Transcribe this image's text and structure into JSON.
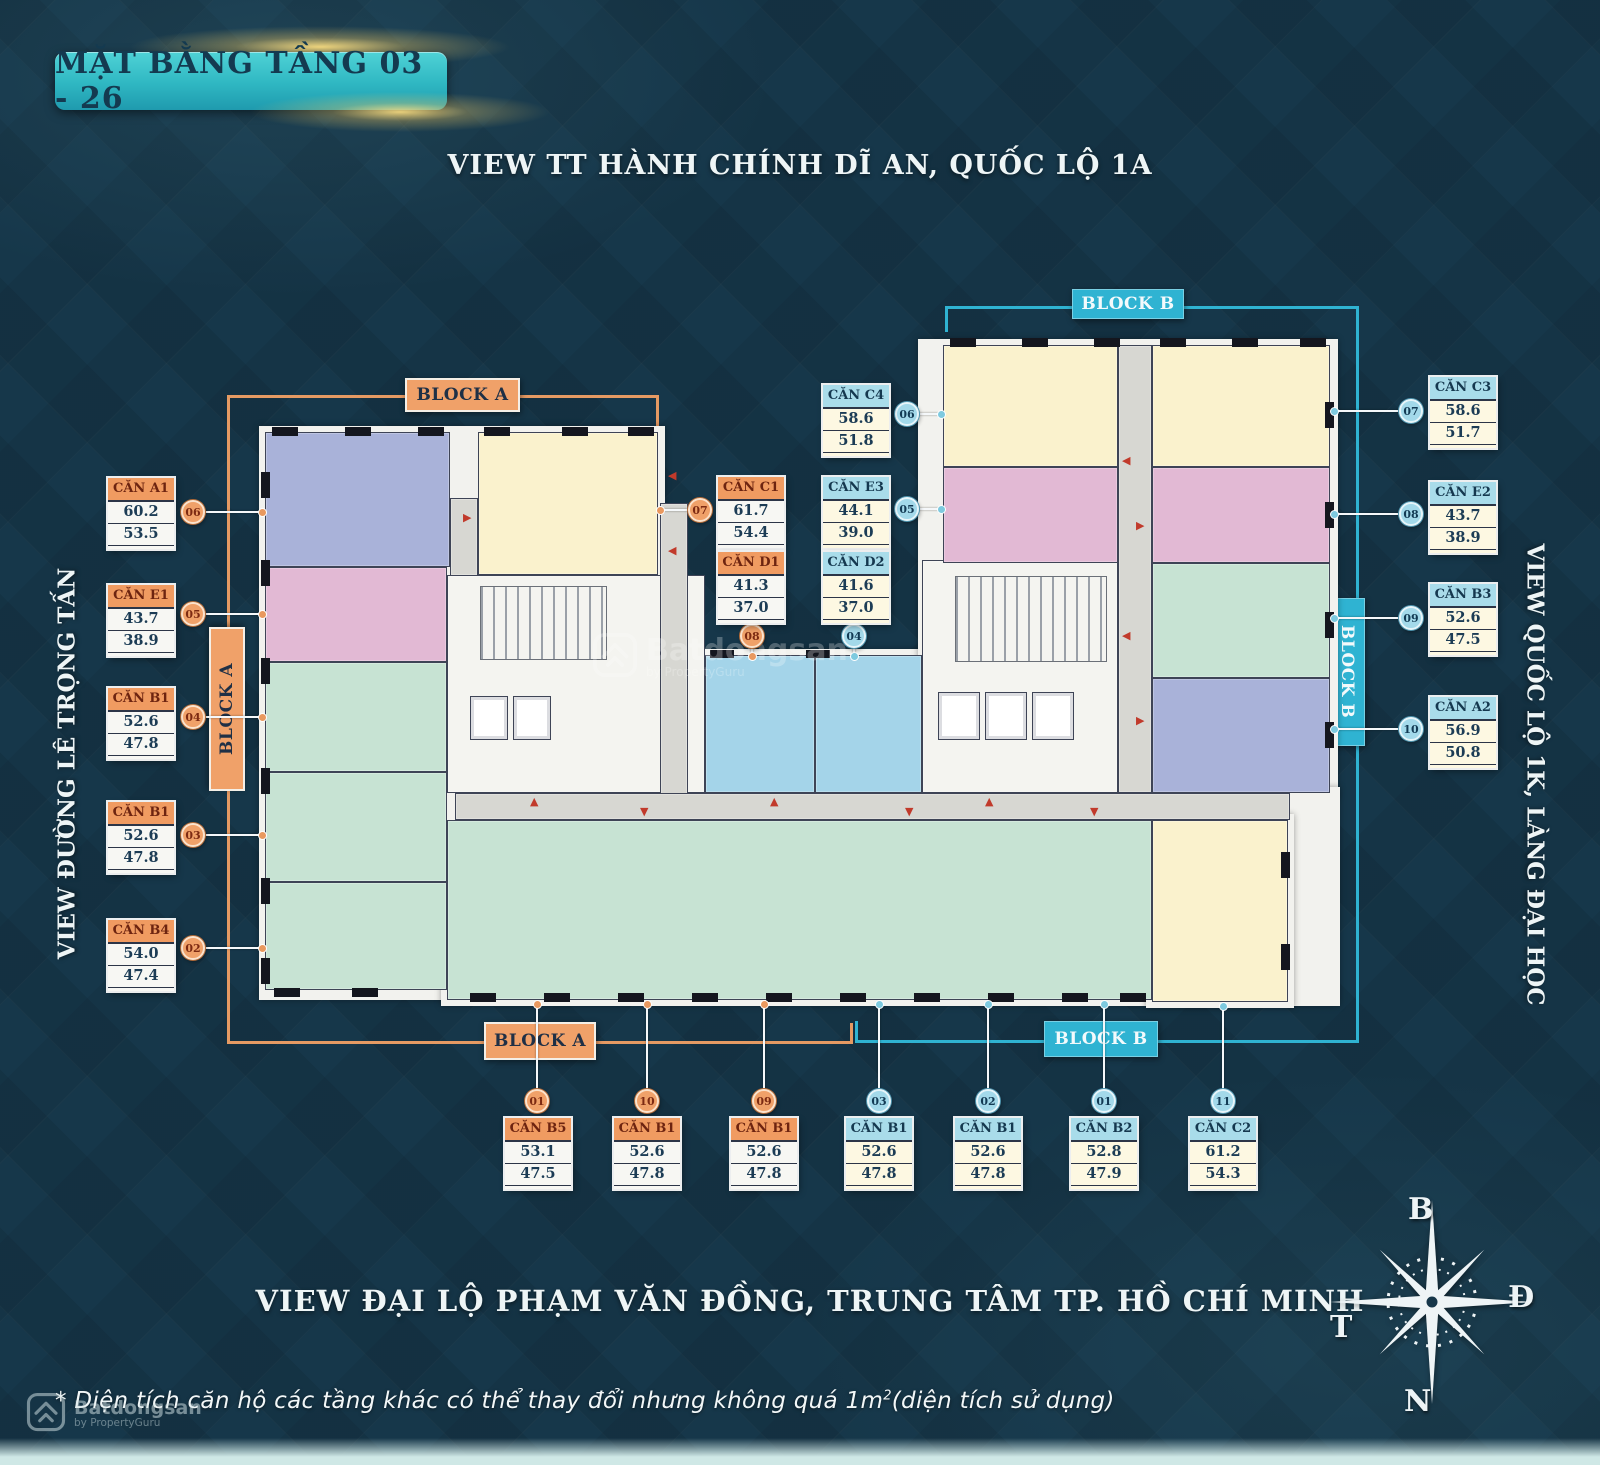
{
  "header": {
    "title": "MẶT BẰNG TẦNG 03 - 26"
  },
  "views": {
    "top": "VIEW  TT HÀNH CHÍNH DĨ AN, QUỐC LỘ 1A",
    "bottom": "VIEW ĐẠI LỘ PHẠM VĂN ĐỒNG, TRUNG TÂM TP. HỒ CHÍ MINH",
    "left": "VIEW ĐƯỜNG LÊ TRỌNG TẤN",
    "right": "VIEW QUỐC LỘ 1K, LÀNG ĐẠI HỌC"
  },
  "blocks": {
    "a": "BLOCK A",
    "b": "BLOCK B"
  },
  "compass": {
    "north": "B",
    "east": "Đ",
    "west": "T",
    "south": "N"
  },
  "footnote": {
    "part1": "* Diện tích căn hộ các tầng khác có thể thay đổi nhưng không quá 1m",
    "sup": "2",
    "part2": "(diện tích sử dụng)"
  },
  "watermark": {
    "brand": "Batdongsan",
    "sub": "by PropertyGuru"
  },
  "colors": {
    "background": "#16374a",
    "accent_orange": "#e59a63",
    "accent_cyan": "#2fb3d2",
    "title_badge": "#2fb7c2",
    "title_text": "#143a50",
    "card_header_a": "#f09b61",
    "card_header_a_text": "#6d2410",
    "card_header_b": "#a9dcea",
    "card_header_b_text": "#15384f",
    "card_body_a": "#f7f7f3",
    "card_body_b": "#fdf8e2",
    "number_text": "#1c3c55",
    "marker_red": "#c13a2b",
    "connector": "#f5f8fa"
  },
  "units": [
    {
      "id": "a1-06",
      "name": "CĂN A1",
      "area1": "60.2",
      "area2": "53.5",
      "num": "06",
      "block": "A",
      "card": [
        108,
        478
      ],
      "circle": [
        193,
        512
      ],
      "line": [
        204,
        511,
        265,
        511
      ],
      "dot": [
        262,
        512
      ]
    },
    {
      "id": "e1-05",
      "name": "CĂN E1",
      "area1": "43.7",
      "area2": "38.9",
      "num": "05",
      "block": "A",
      "card": [
        108,
        585
      ],
      "circle": [
        193,
        614
      ],
      "line": [
        204,
        613,
        265,
        613
      ],
      "dot": [
        262,
        614
      ]
    },
    {
      "id": "b1-04",
      "name": "CĂN B1",
      "area1": "52.6",
      "area2": "47.8",
      "num": "04",
      "block": "A",
      "card": [
        108,
        688
      ],
      "circle": [
        193,
        717
      ],
      "line": [
        204,
        716,
        265,
        716
      ],
      "dot": [
        262,
        717
      ]
    },
    {
      "id": "b1-03",
      "name": "CĂN B1",
      "area1": "52.6",
      "area2": "47.8",
      "num": "03",
      "block": "A",
      "card": [
        108,
        802
      ],
      "circle": [
        193,
        835
      ],
      "line": [
        204,
        834,
        265,
        834
      ],
      "dot": [
        262,
        835
      ]
    },
    {
      "id": "b4-02",
      "name": "CĂN B4",
      "area1": "54.0",
      "area2": "47.4",
      "num": "02",
      "block": "A",
      "card": [
        108,
        920
      ],
      "circle": [
        193,
        948
      ],
      "line": [
        204,
        947,
        265,
        947
      ],
      "dot": [
        262,
        948
      ]
    },
    {
      "id": "c1-07",
      "name": "CĂN C1",
      "area1": "61.7",
      "area2": "54.4",
      "num": "07",
      "block": "A",
      "card": [
        718,
        477
      ],
      "circle": [
        700,
        510
      ],
      "line": [
        658,
        509,
        689,
        509
      ],
      "dot": [
        660,
        510
      ]
    },
    {
      "id": "d1-08",
      "name": "CĂN D1",
      "area1": "41.3",
      "area2": "37.0",
      "num": "08",
      "block": "A",
      "card": [
        718,
        552
      ],
      "circle": [
        752,
        636
      ],
      "line": [
        751,
        647,
        751,
        657
      ],
      "dot": [
        752,
        656
      ]
    },
    {
      "id": "c4-06",
      "name": "CĂN C4",
      "area1": "58.6",
      "area2": "51.8",
      "num": "06",
      "block": "B",
      "card": [
        823,
        385
      ],
      "circle": [
        907,
        414
      ],
      "line": [
        918,
        413,
        943,
        413
      ],
      "dot": [
        941,
        414
      ]
    },
    {
      "id": "e3-05",
      "name": "CĂN E3",
      "area1": "44.1",
      "area2": "39.0",
      "num": "05",
      "block": "B",
      "card": [
        823,
        477
      ],
      "circle": [
        907,
        509
      ],
      "line": [
        918,
        508,
        943,
        508
      ],
      "dot": [
        941,
        509
      ]
    },
    {
      "id": "d2-04",
      "name": "CĂN D2",
      "area1": "41.6",
      "area2": "37.0",
      "num": "04",
      "block": "B",
      "card": [
        823,
        552
      ],
      "circle": [
        854,
        636
      ],
      "line": [
        853,
        647,
        853,
        657
      ],
      "dot": [
        854,
        656
      ]
    },
    {
      "id": "c3-07",
      "name": "CĂN C3",
      "area1": "58.6",
      "area2": "51.7",
      "num": "07",
      "block": "B",
      "card": [
        1430,
        377
      ],
      "circle": [
        1411,
        411
      ],
      "line": [
        1332,
        410,
        1399,
        410
      ],
      "dot": [
        1334,
        411
      ]
    },
    {
      "id": "e2-08",
      "name": "CĂN E2",
      "area1": "43.7",
      "area2": "38.9",
      "num": "08",
      "block": "B",
      "card": [
        1430,
        482
      ],
      "circle": [
        1411,
        514
      ],
      "line": [
        1332,
        513,
        1399,
        513
      ],
      "dot": [
        1334,
        514
      ]
    },
    {
      "id": "b3-09",
      "name": "CĂN B3",
      "area1": "52.6",
      "area2": "47.5",
      "num": "09",
      "block": "B",
      "card": [
        1430,
        584
      ],
      "circle": [
        1411,
        618
      ],
      "line": [
        1332,
        617,
        1399,
        617
      ],
      "dot": [
        1334,
        618
      ]
    },
    {
      "id": "a2-10",
      "name": "CĂN A2",
      "area1": "56.9",
      "area2": "50.8",
      "num": "10",
      "block": "B",
      "card": [
        1430,
        697
      ],
      "circle": [
        1411,
        729
      ],
      "line": [
        1332,
        728,
        1399,
        728
      ],
      "dot": [
        1334,
        729
      ]
    },
    {
      "id": "b5-01",
      "name": "CĂN B5",
      "area1": "53.1",
      "area2": "47.5",
      "num": "01",
      "block": "A",
      "card": [
        505,
        1118
      ],
      "circle": [
        537,
        1101
      ],
      "line": [
        536,
        1002,
        536,
        1089
      ],
      "dot": [
        537,
        1004
      ]
    },
    {
      "id": "b1-10",
      "name": "CĂN B1",
      "area1": "52.6",
      "area2": "47.8",
      "num": "10",
      "block": "A",
      "card": [
        614,
        1118
      ],
      "circle": [
        647,
        1101
      ],
      "line": [
        646,
        1002,
        646,
        1089
      ],
      "dot": [
        647,
        1004
      ]
    },
    {
      "id": "b1-09",
      "name": "CĂN B1",
      "area1": "52.6",
      "area2": "47.8",
      "num": "09",
      "block": "A",
      "card": [
        731,
        1118
      ],
      "circle": [
        764,
        1101
      ],
      "line": [
        763,
        1002,
        763,
        1089
      ],
      "dot": [
        764,
        1004
      ]
    },
    {
      "id": "b1-b03",
      "name": "CĂN B1",
      "area1": "52.6",
      "area2": "47.8",
      "num": "03",
      "block": "B",
      "card": [
        846,
        1118
      ],
      "circle": [
        879,
        1101
      ],
      "line": [
        878,
        1002,
        878,
        1089
      ],
      "dot": [
        879,
        1004
      ]
    },
    {
      "id": "b1-b02",
      "name": "CĂN B1",
      "area1": "52.6",
      "area2": "47.8",
      "num": "02",
      "block": "B",
      "card": [
        955,
        1118
      ],
      "circle": [
        988,
        1101
      ],
      "line": [
        987,
        1002,
        987,
        1089
      ],
      "dot": [
        988,
        1004
      ]
    },
    {
      "id": "b2-b01",
      "name": "CĂN B2",
      "area1": "52.8",
      "area2": "47.9",
      "num": "01",
      "block": "B",
      "card": [
        1071,
        1118
      ],
      "circle": [
        1104,
        1101
      ],
      "line": [
        1103,
        1002,
        1103,
        1089
      ],
      "dot": [
        1104,
        1004
      ]
    },
    {
      "id": "c2-11",
      "name": "CĂN C2",
      "area1": "61.2",
      "area2": "54.3",
      "num": "11",
      "block": "B",
      "card": [
        1190,
        1118
      ],
      "circle": [
        1223,
        1101
      ],
      "line": [
        1222,
        1004,
        1222,
        1089
      ],
      "dot": [
        1223,
        1006
      ]
    }
  ],
  "floorplan": {
    "palette": {
      "lavender": "#a9b2d9",
      "pink": "#e2b9d4",
      "green": "#c7e3d3",
      "yellow": "#faf2cd",
      "blue": "#a4d4e9",
      "gray": "#d7d7d2",
      "white": "#f4f4f0"
    },
    "backdrops": [
      [
        259,
        426,
        406,
        574
      ],
      [
        700,
        649,
        228,
        150
      ],
      [
        918,
        339,
        420,
        460
      ],
      [
        441,
        787,
        899,
        219
      ],
      [
        1146,
        814,
        148,
        194
      ]
    ],
    "rooms": [
      {
        "id": "unit-a1-room",
        "fill": "lavender",
        "r": [
          265,
          432,
          185,
          135
        ]
      },
      {
        "id": "unit-c1-room",
        "fill": "yellow",
        "r": [
          478,
          432,
          180,
          143
        ]
      },
      {
        "id": "unit-e1-room",
        "fill": "pink",
        "r": [
          265,
          567,
          182,
          95
        ]
      },
      {
        "id": "unit-b1-04-room",
        "fill": "green",
        "r": [
          265,
          662,
          182,
          110
        ]
      },
      {
        "id": "unit-b1-03-room",
        "fill": "green",
        "r": [
          265,
          772,
          182,
          110
        ]
      },
      {
        "id": "unit-b4-02-room",
        "fill": "green",
        "r": [
          265,
          882,
          182,
          108
        ]
      },
      {
        "id": "corridor-a-top",
        "fill": "gray",
        "r": [
          450,
          498,
          28,
          78
        ]
      },
      {
        "id": "core-a",
        "fill": "white",
        "r": [
          447,
          575,
          258,
          218
        ]
      },
      {
        "id": "corridor-center",
        "fill": "gray",
        "r": [
          660,
          503,
          28,
          292
        ]
      },
      {
        "id": "unit-d1-room",
        "fill": "blue",
        "r": [
          705,
          655,
          110,
          138
        ]
      },
      {
        "id": "unit-d2-room",
        "fill": "blue",
        "r": [
          815,
          655,
          107,
          138
        ]
      },
      {
        "id": "core-center",
        "fill": "white",
        "r": [
          922,
          560,
          196,
          233
        ]
      },
      {
        "id": "unit-c4-room",
        "fill": "yellow",
        "r": [
          943,
          345,
          175,
          122
        ]
      },
      {
        "id": "unit-c3-room",
        "fill": "yellow",
        "r": [
          1152,
          345,
          178,
          122
        ]
      },
      {
        "id": "unit-e3-room",
        "fill": "pink",
        "r": [
          943,
          467,
          175,
          96
        ]
      },
      {
        "id": "unit-e2-room",
        "fill": "pink",
        "r": [
          1152,
          467,
          178,
          96
        ]
      },
      {
        "id": "unit-b3-room",
        "fill": "green",
        "r": [
          1152,
          563,
          178,
          115
        ]
      },
      {
        "id": "unit-a2-room",
        "fill": "lavender",
        "r": [
          1152,
          678,
          178,
          115
        ]
      },
      {
        "id": "corridor-b-vert",
        "fill": "gray",
        "r": [
          1118,
          345,
          34,
          448
        ]
      },
      {
        "id": "corridor-main",
        "fill": "gray",
        "r": [
          455,
          793,
          835,
          27
        ]
      },
      {
        "id": "wing-studios",
        "fill": "green",
        "r": [
          447,
          820,
          705,
          180
        ],
        "cls": "wing"
      },
      {
        "id": "unit-c2-room",
        "fill": "yellow",
        "r": [
          1152,
          820,
          136,
          182
        ]
      }
    ],
    "stairs": [
      [
        480,
        586,
        125,
        72
      ],
      [
        955,
        576,
        150,
        84
      ]
    ],
    "elevators": [
      [
        470,
        696,
        38,
        44
      ],
      [
        513,
        696,
        38,
        44
      ],
      [
        938,
        692,
        42,
        48
      ],
      [
        985,
        692,
        42,
        48
      ],
      [
        1032,
        692,
        42,
        48
      ]
    ],
    "piers": [
      [
        272,
        427,
        26,
        9
      ],
      [
        345,
        427,
        26,
        9
      ],
      [
        418,
        427,
        26,
        9
      ],
      [
        484,
        427,
        26,
        9
      ],
      [
        562,
        427,
        26,
        9
      ],
      [
        628,
        427,
        26,
        9
      ],
      [
        261,
        472,
        9,
        26
      ],
      [
        261,
        560,
        9,
        26
      ],
      [
        261,
        658,
        9,
        26
      ],
      [
        261,
        768,
        9,
        26
      ],
      [
        261,
        878,
        9,
        26
      ],
      [
        261,
        958,
        9,
        26
      ],
      [
        274,
        988,
        26,
        9
      ],
      [
        352,
        988,
        26,
        9
      ],
      [
        470,
        993,
        26,
        9
      ],
      [
        544,
        993,
        26,
        9
      ],
      [
        618,
        993,
        26,
        9
      ],
      [
        692,
        993,
        26,
        9
      ],
      [
        766,
        993,
        26,
        9
      ],
      [
        840,
        993,
        26,
        9
      ],
      [
        914,
        993,
        26,
        9
      ],
      [
        988,
        993,
        26,
        9
      ],
      [
        1062,
        993,
        26,
        9
      ],
      [
        1120,
        993,
        26,
        9
      ],
      [
        950,
        338,
        26,
        9
      ],
      [
        1022,
        338,
        26,
        9
      ],
      [
        1094,
        338,
        26,
        9
      ],
      [
        1160,
        338,
        26,
        9
      ],
      [
        1232,
        338,
        26,
        9
      ],
      [
        1300,
        338,
        26,
        9
      ],
      [
        1325,
        402,
        9,
        26
      ],
      [
        1325,
        502,
        9,
        26
      ],
      [
        1325,
        612,
        9,
        26
      ],
      [
        1325,
        722,
        9,
        26
      ],
      [
        1281,
        852,
        9,
        26
      ],
      [
        1281,
        944,
        9,
        26
      ],
      [
        710,
        650,
        24,
        8
      ],
      [
        806,
        650,
        24,
        8
      ]
    ],
    "markers": [
      {
        "d": "right",
        "x": 463,
        "y": 512
      },
      {
        "d": "left",
        "x": 668,
        "y": 470
      },
      {
        "d": "left",
        "x": 668,
        "y": 545
      },
      {
        "d": "up",
        "x": 530,
        "y": 796
      },
      {
        "d": "down",
        "x": 640,
        "y": 806
      },
      {
        "d": "up",
        "x": 770,
        "y": 796
      },
      {
        "d": "down",
        "x": 905,
        "y": 806
      },
      {
        "d": "up",
        "x": 985,
        "y": 796
      },
      {
        "d": "down",
        "x": 1090,
        "y": 806
      },
      {
        "d": "left",
        "x": 1122,
        "y": 455
      },
      {
        "d": "right",
        "x": 1136,
        "y": 520
      },
      {
        "d": "left",
        "x": 1122,
        "y": 630
      },
      {
        "d": "right",
        "x": 1136,
        "y": 715
      }
    ]
  }
}
